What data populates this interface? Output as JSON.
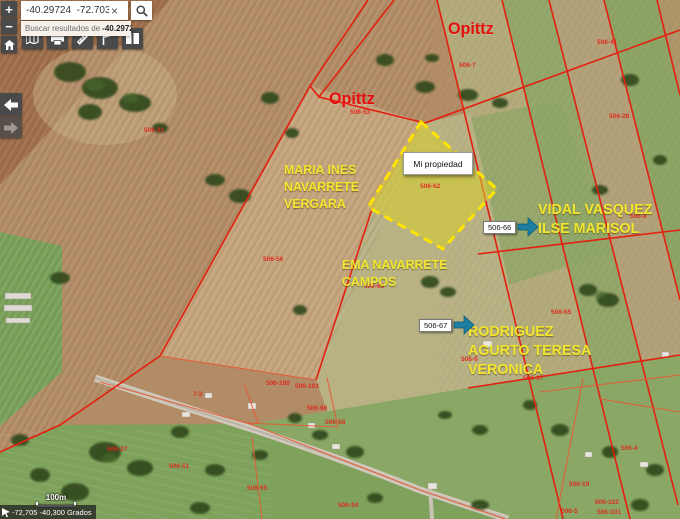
{
  "colors": {
    "boundary_red": "#e3200f",
    "highlight_yellow": "#ffe400",
    "owner_yellow": "#f2e72e",
    "opittz_red": "#e60d0d",
    "arrow_teal": "#1c7fa2",
    "chrome_dark": "#4a4a4a"
  },
  "search": {
    "query": "-40.29724  -72.703725",
    "clear_label": "×",
    "suggestion_prefix": "Buscar resultados de",
    "suggestion_term": "-40.29724 -7…"
  },
  "controls": {
    "zoom_in_label": "+",
    "zoom_out_label": "−",
    "toolbar_icons": [
      "basemap-icon",
      "print-icon",
      "measure-icon",
      "flag-icon",
      "table-icon"
    ]
  },
  "statusbar": {
    "scale_label": "100m",
    "cursor_coords": "-72,705 -40,300 Grados"
  },
  "map": {
    "property_label": "Mi propiedad",
    "owners": {
      "opittz_north": "Opittz",
      "opittz_west": "Opittz",
      "maria": [
        "MARIA INES",
        "NAVARRETE",
        "VERGARA"
      ],
      "ema": [
        "EMA NAVARRETE",
        "CAMPOS"
      ],
      "vidal": [
        "VIDAL VASQUEZ",
        "ILSE MARISOL"
      ],
      "rodriguez": [
        "RODRIGUEZ",
        "AGURTO TERESA",
        "VERONICA"
      ]
    },
    "callouts": [
      {
        "label": "506-66",
        "x": 483,
        "y": 216
      },
      {
        "label": "506-67",
        "x": 419,
        "y": 314
      }
    ],
    "parcel_numbers": [
      {
        "label": "506-41",
        "x": 597,
        "y": 39
      },
      {
        "label": "506-7",
        "x": 459,
        "y": 62
      },
      {
        "label": "506-53",
        "x": 350,
        "y": 109
      },
      {
        "label": "506-28",
        "x": 609,
        "y": 113
      },
      {
        "label": "506-31",
        "x": 144,
        "y": 127
      },
      {
        "label": "506-62",
        "x": 420,
        "y": 183
      },
      {
        "label": "506-8",
        "x": 630,
        "y": 213
      },
      {
        "label": "506-56",
        "x": 263,
        "y": 256
      },
      {
        "label": "506-63",
        "x": 364,
        "y": 283
      },
      {
        "label": "506-65",
        "x": 551,
        "y": 309
      },
      {
        "label": "506-9",
        "x": 461,
        "y": 356
      },
      {
        "label": "506-17",
        "x": 523,
        "y": 375
      },
      {
        "label": "506-100",
        "x": 266,
        "y": 380
      },
      {
        "label": "506-103",
        "x": 295,
        "y": 383
      },
      {
        "label": "7-2",
        "x": 193,
        "y": 391
      },
      {
        "label": "506-60",
        "x": 307,
        "y": 405
      },
      {
        "label": "506-58",
        "x": 325,
        "y": 419
      },
      {
        "label": "506-27",
        "x": 107,
        "y": 446
      },
      {
        "label": "506-4",
        "x": 621,
        "y": 445
      },
      {
        "label": "506-51",
        "x": 169,
        "y": 463
      },
      {
        "label": "506-19",
        "x": 569,
        "y": 481
      },
      {
        "label": "506-55",
        "x": 247,
        "y": 485
      },
      {
        "label": "506-34",
        "x": 338,
        "y": 502
      },
      {
        "label": "506-102",
        "x": 595,
        "y": 499
      },
      {
        "label": "506-5",
        "x": 561,
        "y": 508
      },
      {
        "label": "506-101",
        "x": 597,
        "y": 509
      }
    ]
  }
}
